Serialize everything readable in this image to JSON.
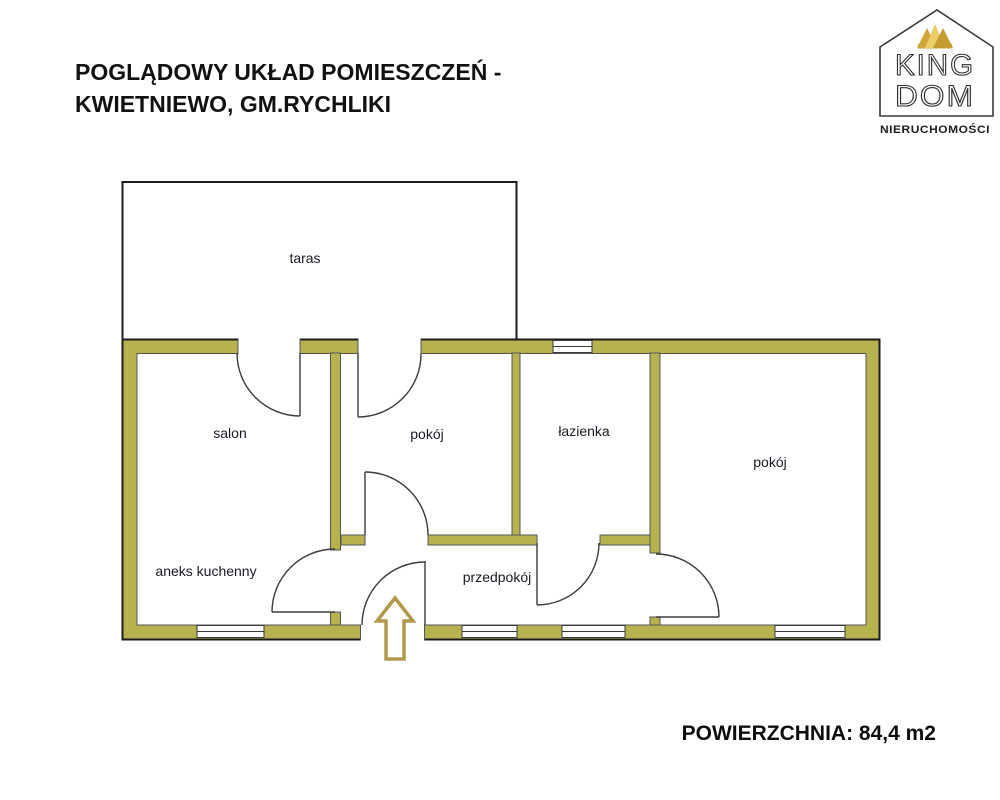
{
  "header": {
    "title_line1": "POGLĄDOWY UKŁAD POMIESZCZEŃ -",
    "title_line2": "KWIETNIEWO, GM.RYCHLIKI"
  },
  "logo": {
    "king": "KING",
    "dom": "DOM",
    "subtitle": "NIERUCHOMOŚCI"
  },
  "floorplan": {
    "rooms": {
      "taras": "taras",
      "salon": "salon",
      "room_middle": "pokój",
      "bathroom": "łazienka",
      "room_right": "pokój",
      "kitchenette": "aneks kuchenny",
      "hallway": "przedpokój"
    }
  },
  "footer": {
    "area_text": "POWIERZCHNIA: 84,4 m2"
  },
  "colors": {
    "wall": "#b6b24e",
    "wall_outline": "#1c1c1c",
    "interior_line": "#555555",
    "door_line": "#3c3c3c",
    "entrance_arrow": "#b2984b",
    "crown_gold_light": "#eacd67",
    "crown_gold_dark": "#c49b2f"
  }
}
